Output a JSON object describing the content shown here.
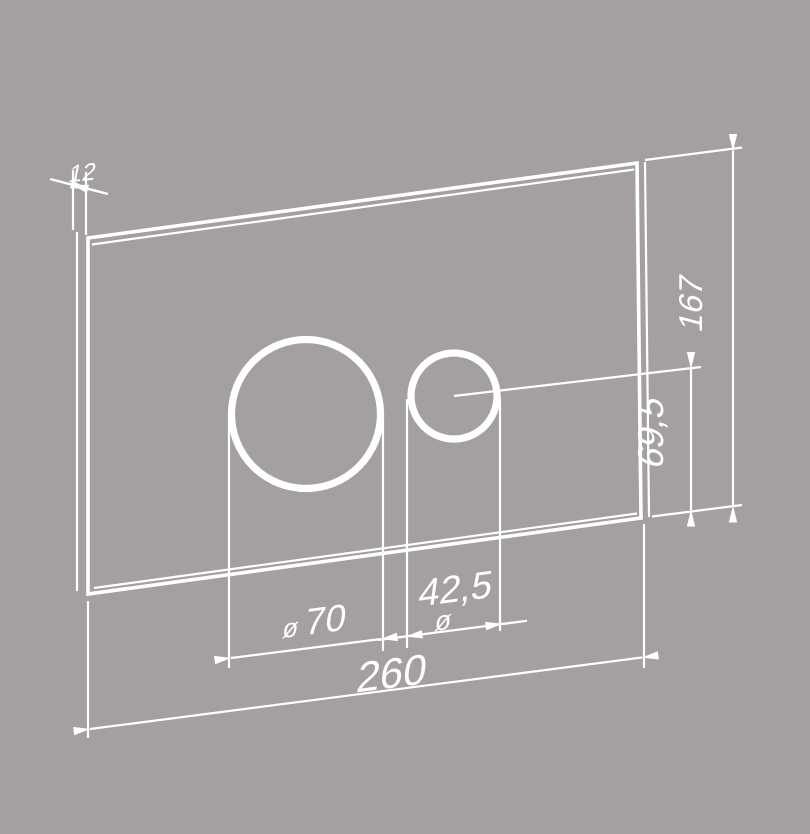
{
  "colors": {
    "background": "#a3a09f",
    "ink": "#ffffff"
  },
  "drawing": {
    "description": "Technical dimension drawing (oblique view) of a rectangular plate with one large and one small circular opening",
    "dimensions": {
      "thickness": {
        "value": "12"
      },
      "plate_height": {
        "value": "167"
      },
      "hole_center_offset": {
        "value": "69,5"
      },
      "large_hole_diameter": {
        "symbol": "ø",
        "value": "70"
      },
      "small_hole_diameter": {
        "symbol": "ø",
        "value": "42,5"
      },
      "plate_width": {
        "value": "260"
      }
    }
  }
}
